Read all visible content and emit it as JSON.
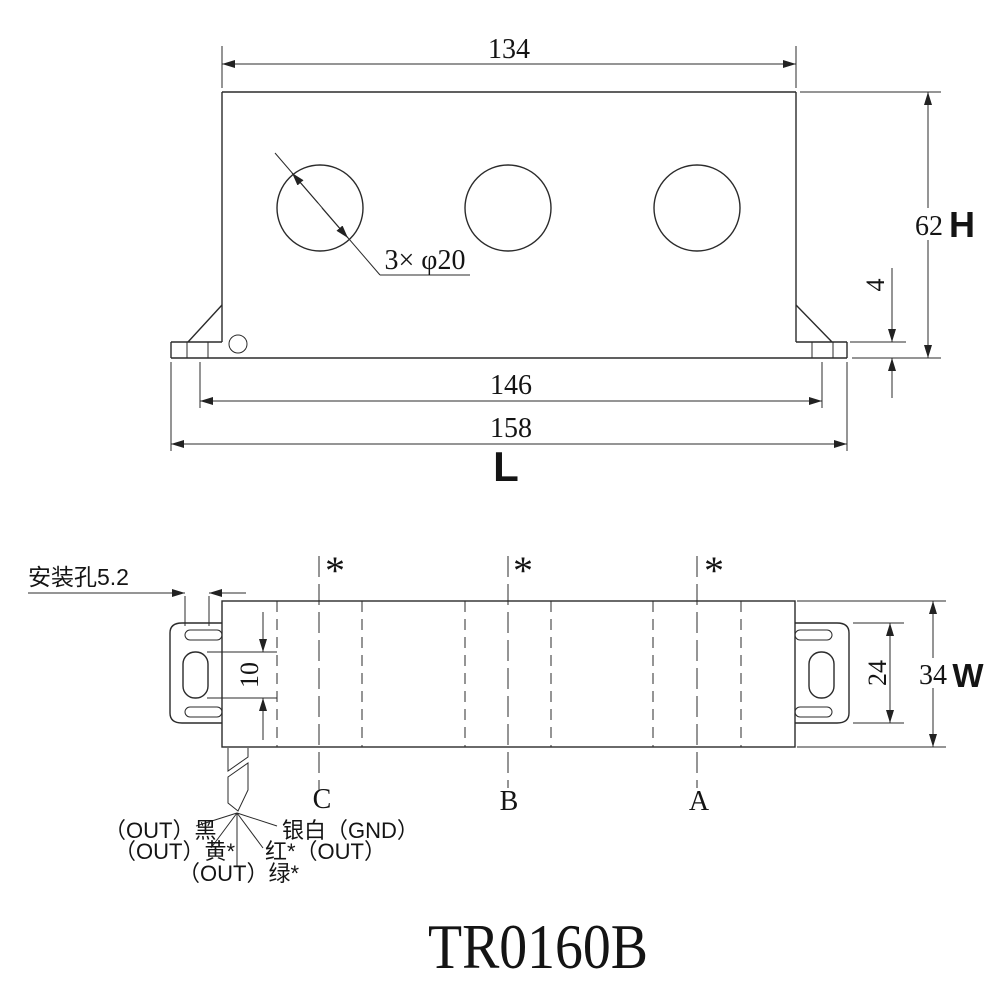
{
  "title": "TR0160B",
  "front_view": {
    "dim_body_width": "134",
    "dim_height": "62",
    "height_symbol": "H",
    "dim_foot_thickness": "4",
    "dim_mount_hole_spacing": "146",
    "dim_overall_length": "158",
    "length_symbol": "L",
    "holes_label": "3× φ20"
  },
  "plan_view": {
    "mounting_hole_label": "安装孔5.2",
    "dim_slot_length": "10",
    "dim_bracket_width": "24",
    "dim_overall_width": "34",
    "width_symbol": "W",
    "asterisk": "*",
    "phase_labels": [
      "C",
      "B",
      "A"
    ]
  },
  "wiring": {
    "label_black": "（OUT）黑",
    "label_yellow": "（OUT）黄*",
    "label_green": "（OUT）绿*",
    "label_red": "红*（OUT）",
    "label_ground": "银白（GND）"
  }
}
